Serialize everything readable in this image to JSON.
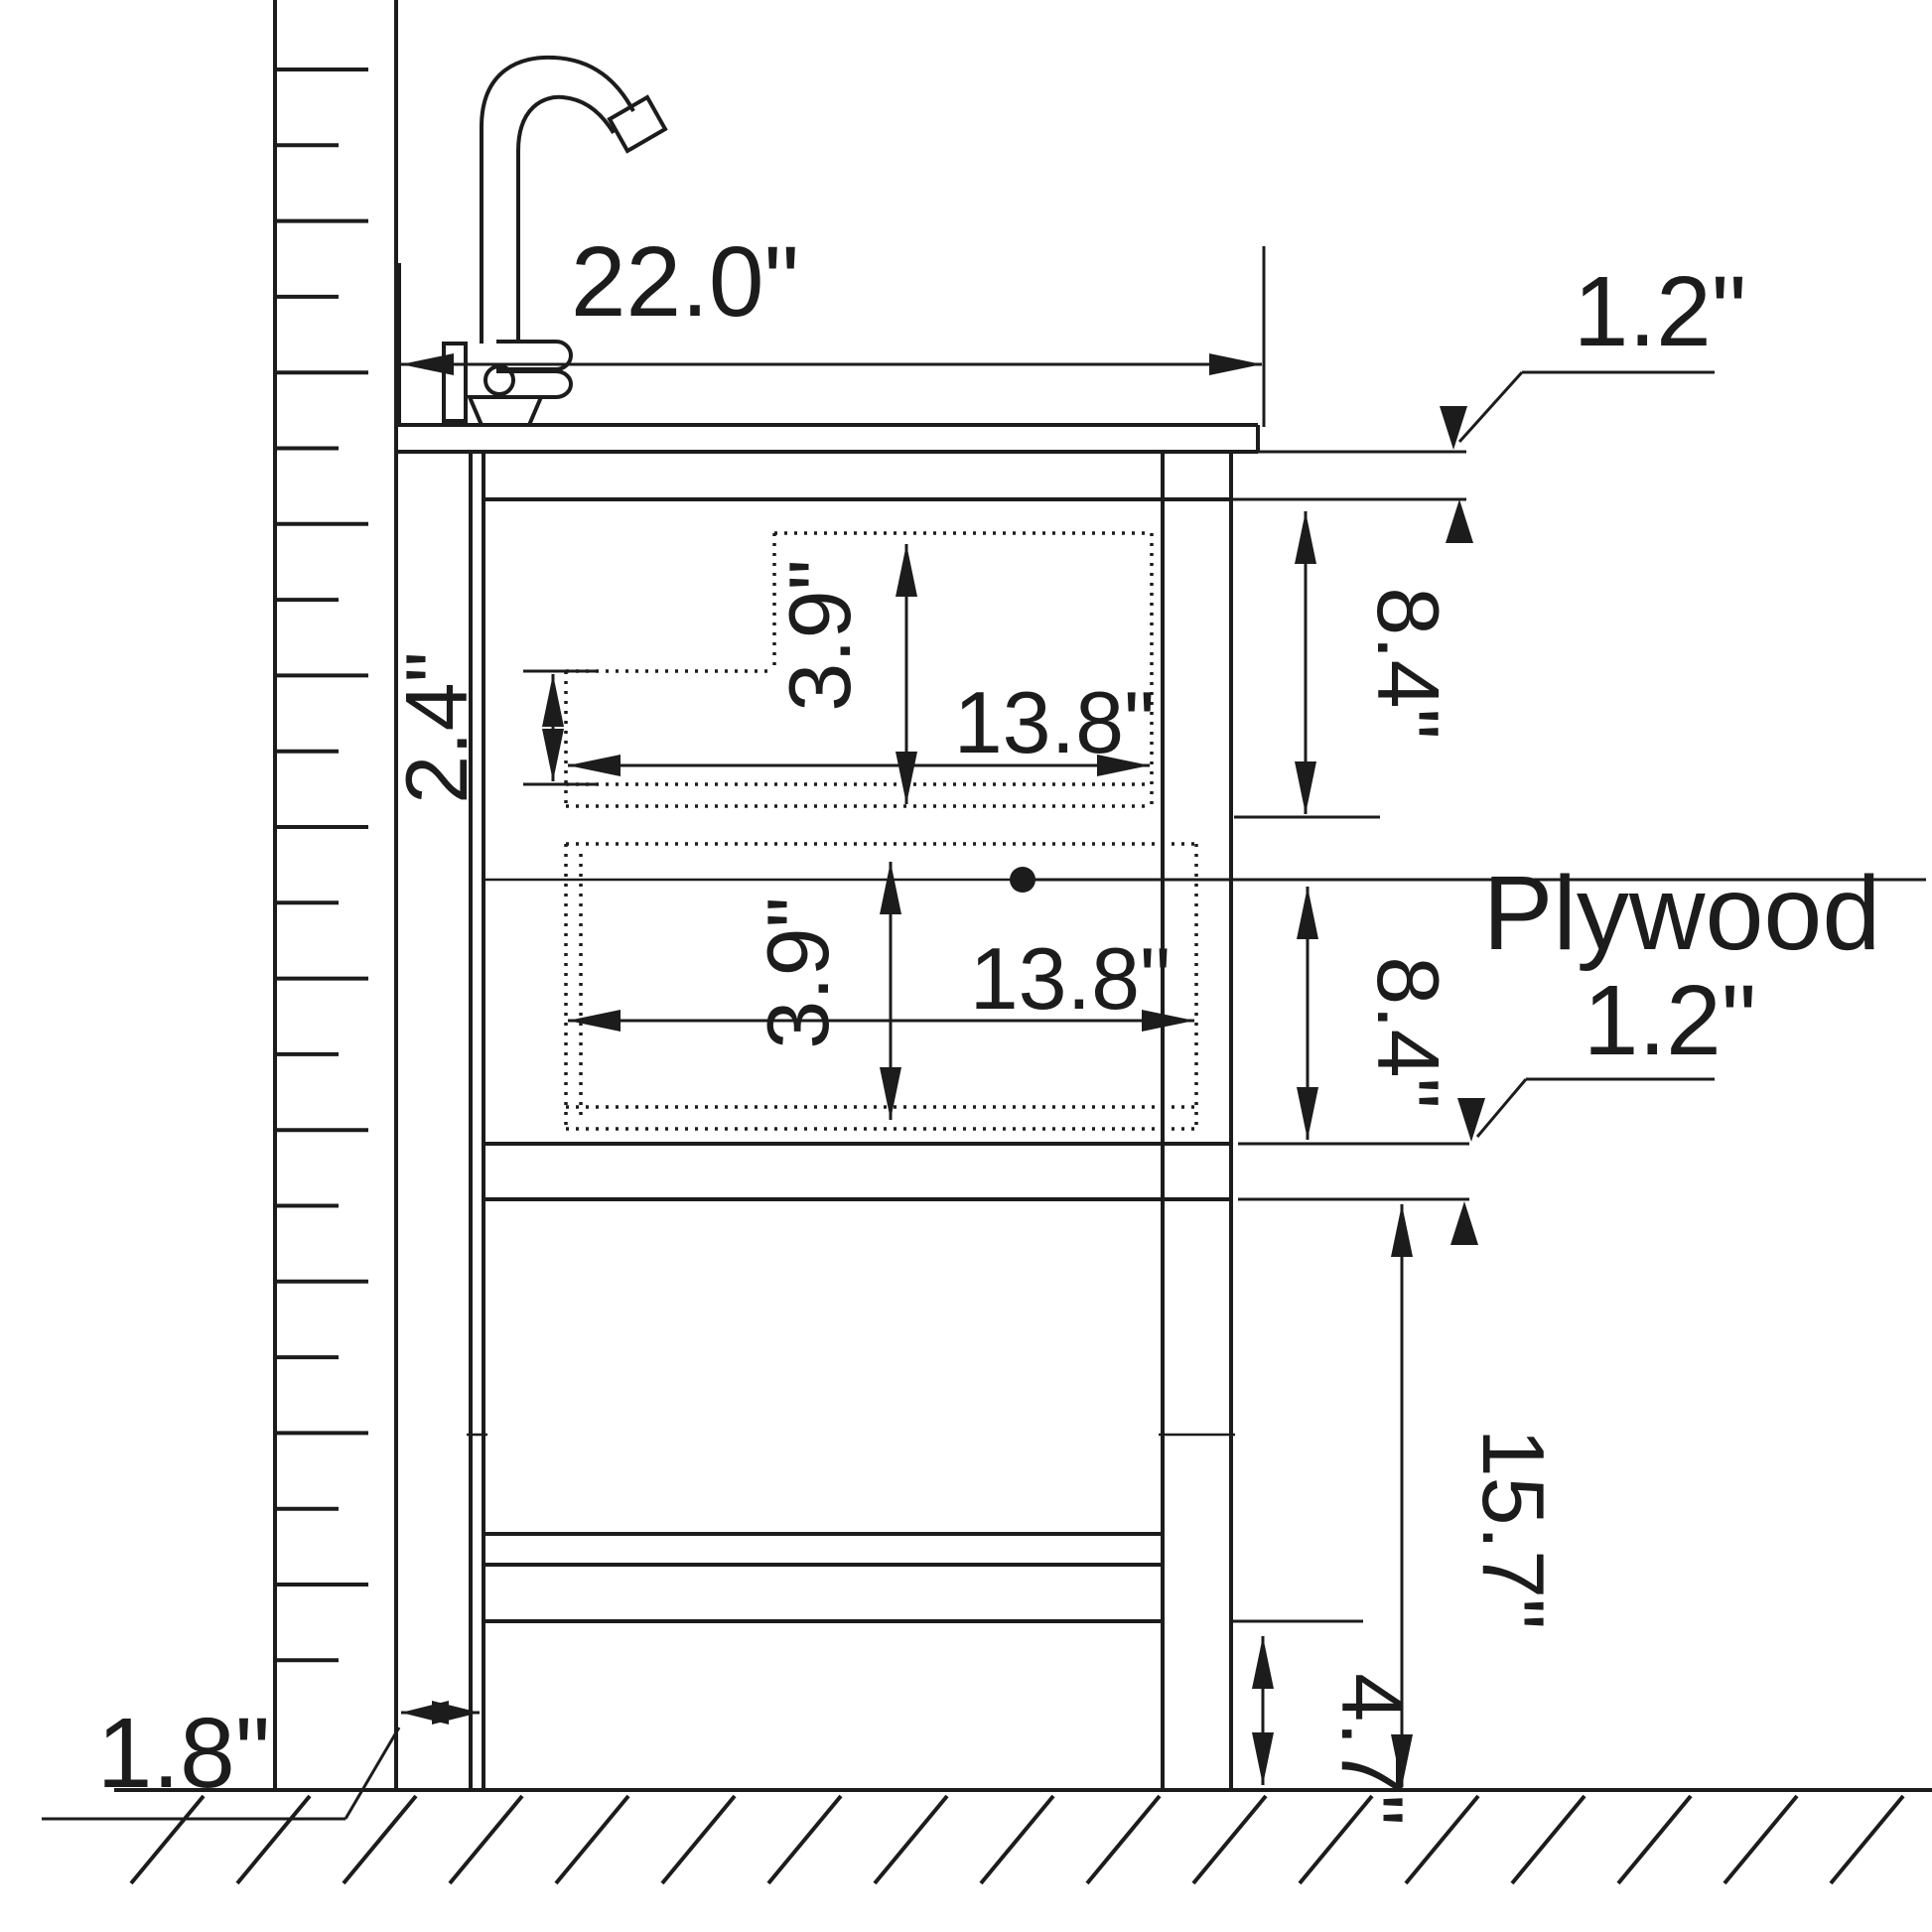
{
  "drawing": {
    "title": "Bathroom vanity cabinet side-section dimension drawing",
    "material_note": "Plywood",
    "dimensions": {
      "countertop_width": "22.0\"",
      "top_rail_thickness": "1.2\"",
      "upper_section_height": "8.4\"",
      "lower_section_height": "8.4\"",
      "shelf_thickness": "1.2\"",
      "upper_drawer_width": "13.8\"",
      "lower_drawer_width": "13.8\"",
      "upper_drawer_height": "3.9\"",
      "lower_drawer_height": "3.9\"",
      "drawer_front_step": "2.4\"",
      "leg_space_height": "15.7\"",
      "bottom_clearance": "4.7\"",
      "wall_gap": "1.8\""
    }
  }
}
